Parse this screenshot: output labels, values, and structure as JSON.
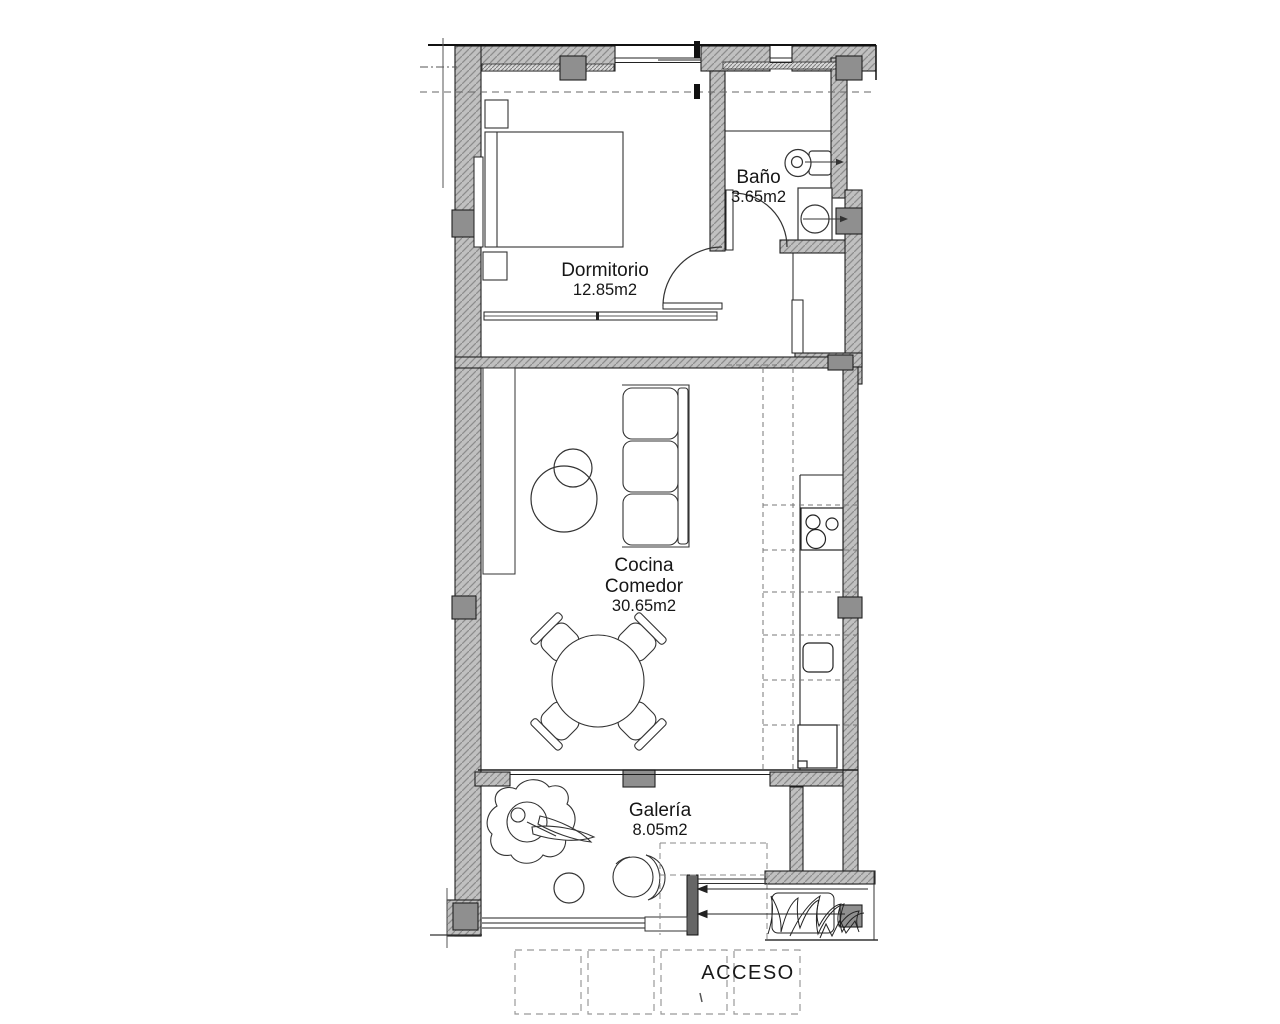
{
  "plan": {
    "rooms": [
      {
        "id": "dormitorio",
        "name": "Dormitorio",
        "area": "12.85m2"
      },
      {
        "id": "bano",
        "name": "Baño",
        "area": "3.65m2"
      },
      {
        "id": "cocina_comedor",
        "name": "Cocina\nComedor",
        "area": "30.65m2"
      },
      {
        "id": "galeria",
        "name": "Galería",
        "area": "8.05m2"
      }
    ],
    "entrance_label": "ACCESO"
  },
  "colors": {
    "background": "#ffffff",
    "ink": "#1c1c1c",
    "wall_fill": "#c0c0c0",
    "wall_hatch": "#8c8c8c",
    "pillar": "#8f8f8f",
    "entry_post": "#666666",
    "dashed_line": "#777777"
  }
}
